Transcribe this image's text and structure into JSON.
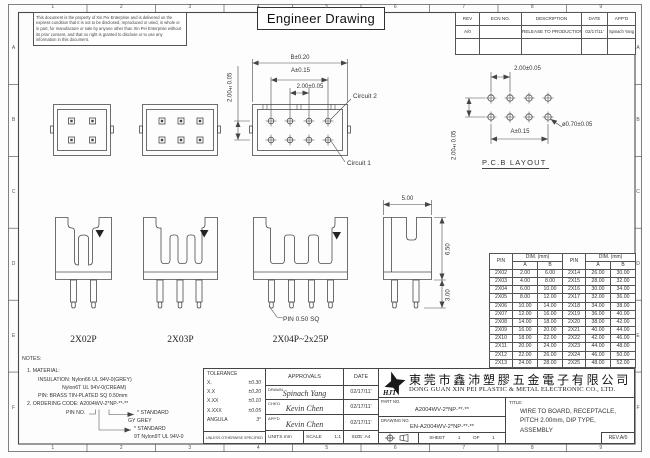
{
  "page": {
    "sheet_title": "Engineer Drawing",
    "notice": "This document is the property of Xin Pei Enterprise and is delivered on the express condition that it is not to be disclosed, reproduced or used, in whole or in part, for manufacture or sale by anyone other than Xin Pei Enterprise without its prior consent, and that no right is granted to disclose or to use any information in this document."
  },
  "grid": {
    "cols": [
      "1",
      "2",
      "3",
      "4",
      "5",
      "6",
      "7",
      "8",
      "9"
    ],
    "rows": [
      "A",
      "B",
      "C",
      "D",
      "E",
      "F"
    ]
  },
  "rev_table": {
    "headers": [
      "REV",
      "ECN NO.",
      "DESCRIPTION",
      "DATE",
      "APP'D"
    ],
    "rows": [
      {
        "rev": "A/0",
        "ecn": "",
        "description": "RELEASE TO PRODUCTION",
        "date": "02/17/11'",
        "appd": "Spinach Yang"
      }
    ]
  },
  "front_view": {
    "dim_b": "B±0.20",
    "dim_a": "A±0.15",
    "dim_pitch": "2.00±0.05",
    "dim_row": "2.00±0.05",
    "circuit2": "Circuit 2",
    "circuit1": "Circuit 1"
  },
  "pcb_layout": {
    "title": "P.C.B LAYOUT",
    "dim_pitch": "2.00±0.05",
    "dim_row": "2.00±0.05",
    "dim_a": "A±0.15",
    "dim_hole": "ø0.70±0.05"
  },
  "side_views": {
    "label_2x02p": "2X02P",
    "label_2x03p": "2X03P",
    "label_2x04p": "2X04P~2x25P",
    "pin_note": "PIN 0.50 SQ",
    "dim_width": "5.00",
    "dim_height": "6.50",
    "dim_pin": "3.00"
  },
  "dim_table": {
    "pin": "PIN",
    "dim": "DIM. (mm)",
    "a": "A",
    "b": "B",
    "left": [
      [
        "2X02",
        "2.00",
        "6.00"
      ],
      [
        "2X03",
        "4.00",
        "8.00"
      ],
      [
        "2X04",
        "6.00",
        "10.00"
      ],
      [
        "2X05",
        "8.00",
        "12.00"
      ],
      [
        "2X06",
        "10.00",
        "14.00"
      ],
      [
        "2X07",
        "12.00",
        "16.00"
      ],
      [
        "2X08",
        "14.00",
        "18.00"
      ],
      [
        "2X09",
        "16.00",
        "20.00"
      ],
      [
        "2X10",
        "18.00",
        "22.00"
      ],
      [
        "2X11",
        "20.00",
        "24.00"
      ],
      [
        "2X12",
        "22.00",
        "26.00"
      ],
      [
        "2X13",
        "24.00",
        "28.00"
      ]
    ],
    "right": [
      [
        "2X14",
        "26.00",
        "30.00"
      ],
      [
        "2X15",
        "28.00",
        "32.00"
      ],
      [
        "2X16",
        "30.00",
        "34.00"
      ],
      [
        "2X17",
        "32.00",
        "36.00"
      ],
      [
        "2X18",
        "34.00",
        "38.00"
      ],
      [
        "2X19",
        "36.00",
        "40.00"
      ],
      [
        "2X20",
        "38.00",
        "42.00"
      ],
      [
        "2X21",
        "40.00",
        "44.00"
      ],
      [
        "2X22",
        "42.00",
        "46.00"
      ],
      [
        "2X23",
        "44.00",
        "48.00"
      ],
      [
        "2X24",
        "46.00",
        "50.00"
      ],
      [
        "2X25",
        "48.00",
        "52.00"
      ]
    ]
  },
  "notes": {
    "heading": "NOTES:",
    "l1": "1. MATERIAL:",
    "l2": "INSULATION: Nylon66 UL 94V-0(GREY)",
    "l3": "Nylon6T UL 94V-0(CREAM)",
    "l4": "PIN: BRASS TIN-PLATED SQ 0.50mm",
    "l5": "2. ORDERING CODE: A2004WV-2*NP-**-**",
    "pin_no": "PIN NO.",
    "std1": "* STANDARD",
    "grey": "GY GREY",
    "std2": "* STANDARD",
    "mat": "9T Nylon9T UL 94V-0"
  },
  "title_block": {
    "tolerance": {
      "heading": "TOLERANCE",
      "rows": [
        [
          "X.",
          "±0.30"
        ],
        [
          "X.X",
          "±0.20"
        ],
        [
          "X.XX",
          "±0.10"
        ],
        [
          "X.XXX",
          "±0.05"
        ],
        [
          "ANGULA",
          "3°"
        ]
      ],
      "footer": "UNLESS OTHERWISE SPECIFIED"
    },
    "approvals": {
      "heading": "APPROVALS",
      "date_heading": "DATE",
      "rows": [
        {
          "label": "DRAWN",
          "sig": "Spinach Yang",
          "date": "02/17/11'"
        },
        {
          "label": "CHK'D",
          "sig": "Kevin Chen",
          "date": "02/17/11'"
        },
        {
          "label": "APP'D",
          "sig": "Kevin Chen",
          "date": "02/17/11'"
        }
      ],
      "units_label": "UNITS",
      "units": "mm",
      "scale_label": "SCALE",
      "scale": "1:1",
      "size": "SIZE: A4"
    },
    "company": {
      "logo": "HJT",
      "name_cn": "東莞市鑫沛塑膠五金電子有限公司",
      "name_en": "DONG GUAN XIN PEI PLASTIC & METAL ELECTRONIC CO., LTD.",
      "part_no_label": "PART NO.",
      "part_no": "A2004WV-2*NP-**-**",
      "drawing_no_label": "DRAWING NO.",
      "drawing_no": "EN-A2004WV-2*NP-**-**",
      "sheet": [
        "SHEET",
        "1",
        "OF",
        "1"
      ],
      "title_label": "TITLE:",
      "title_lines": [
        "WIRE TO BOARD, RECEPTACLE,",
        "PITCH 2.00mm, DIP TYPE,",
        "ASSEMBLY"
      ],
      "rev": "REV.A/0"
    }
  }
}
